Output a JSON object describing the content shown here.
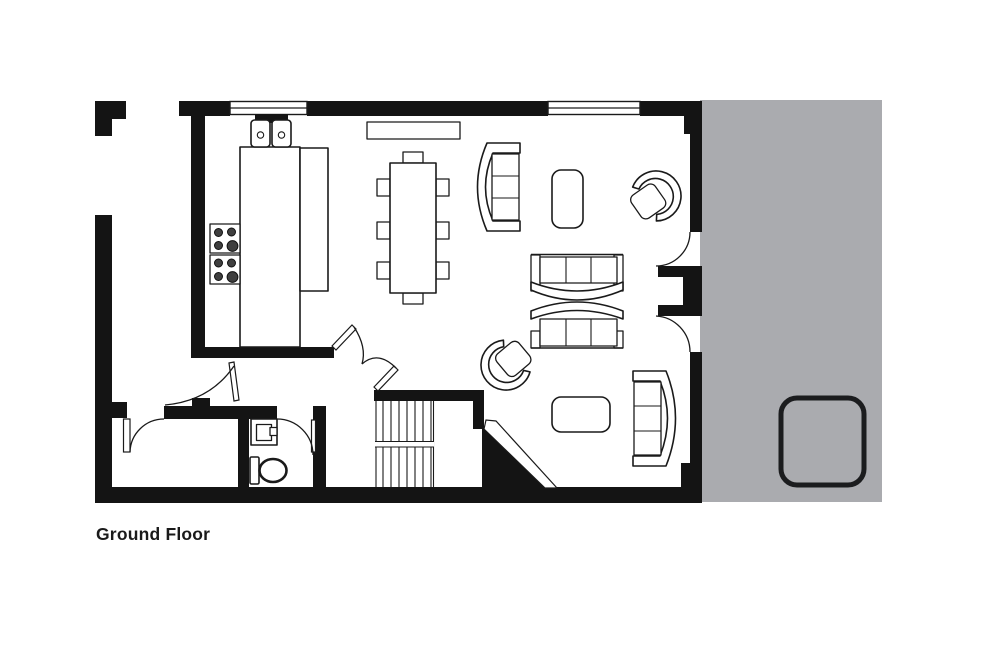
{
  "plan": {
    "title": "Ground Floor"
  },
  "colors": {
    "wall": "#141414",
    "terrace": "#aaabaf",
    "line": "#1a1a1a",
    "paper": "#ffffff",
    "title_text": "#1a1a1a"
  },
  "elements": {
    "windows_count": 2,
    "door_swings_count": 7,
    "furniture_icons": {
      "kitchen": [
        "double-sink",
        "l-shaped-counter",
        "cooktop-two-4-burner-hobs"
      ],
      "dining": [
        "sideboard",
        "dining-table",
        "dining-chairs-x8"
      ],
      "living": [
        "curved-3-seat-sofa-x4",
        "tub-armchair-x2",
        "rounded-coffee-table-x2"
      ],
      "wc": [
        "washbasin",
        "toilet"
      ],
      "circulation": [
        "staircase-with-landing",
        "double-swing-doors",
        "under-stair-diagonal-wall"
      ],
      "terrace": [
        "hot-tub"
      ]
    }
  }
}
